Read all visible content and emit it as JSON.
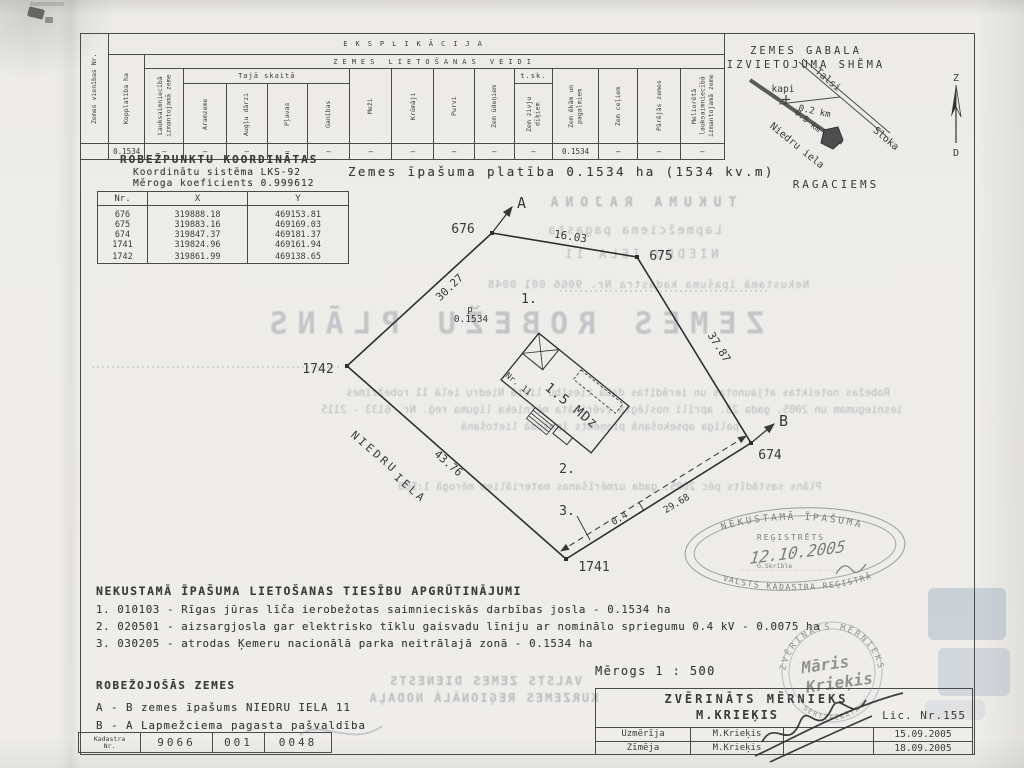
{
  "explication": {
    "title": "EKSPLIKĀCIJA",
    "land_use_title": "ZEMES LIETOŠANAS VEIDI",
    "including": "Tajā skaitā",
    "tsk": "t.sk.",
    "col_unit": "Zemes vienības Nr.",
    "col_total": "Kopplatība ha",
    "col_agri": "Lauksaimniecībā izmantojamā zeme",
    "col_arable": "Aramzeme",
    "col_orchards": "Augļu dārzi",
    "col_meadows": "Pļavas",
    "col_pastures": "Ganības",
    "col_forests": "Meži",
    "col_shrubs": "Krūmāji",
    "col_swamps": "Purvi",
    "col_water": "Zem ūdeņiem",
    "col_fishponds": "Zem zivju dīķiem",
    "col_buildings": "Zem ēkām un pagalmiem",
    "col_roads": "Zem ceļiem",
    "col_other": "Pārējās zemes",
    "col_ameliorated": "Meliorētā lauksaimniecībā izmantojamā zeme",
    "row": {
      "unit": "",
      "total": "0.1534",
      "agri": "—",
      "arable": "—",
      "orchards": "—",
      "meadows": "—",
      "pastures": "—",
      "forests": "—",
      "shrubs": "—",
      "swamps": "—",
      "water": "—",
      "fishponds": "—",
      "buildings": "0.1534",
      "roads": "—",
      "other": "—",
      "ameliorated": "—"
    }
  },
  "coords": {
    "title": "ROBEŽPUNKTU KOORDINĀTAS",
    "system": "Koordinātu sistēma LKS-92",
    "scale_coef": "Mēroga koeficients 0.999612",
    "headers": {
      "nr": "Nr.",
      "x": "X",
      "y": "Y"
    },
    "rows": [
      {
        "nr": "676",
        "x": "319888.18",
        "y": "469153.81"
      },
      {
        "nr": "675",
        "x": "319883.16",
        "y": "469169.03"
      },
      {
        "nr": "674",
        "x": "319847.37",
        "y": "469181.37"
      },
      {
        "nr": "1741",
        "x": "319824.96",
        "y": "469161.94"
      },
      {
        "nr": "1742",
        "x": "319861.99",
        "y": "469138.65"
      }
    ]
  },
  "area_statement": "Zemes īpašuma platība 0.1534 ha (1534 kv.m)",
  "scheme": {
    "title1": "ZEMES GABALA",
    "title2": "IZVIETOJUMA SHĒMA",
    "road_up": "Talsi",
    "road_down": "Sloka",
    "street": "Niedru iela",
    "cemetery": "kapi",
    "dist1": "0.2 km",
    "dist2": "0.5 km",
    "village": "RAGACIEMS",
    "north": "Z",
    "south": "D"
  },
  "plan": {
    "dirA": "A",
    "dirB": "B",
    "p676": "676",
    "p675": "675",
    "p674": "674",
    "p1741": "1741",
    "p1742": "1742",
    "len_676_675": "16.03",
    "len_675_674": "37.87",
    "len_1742_1741": "43.76",
    "len_676_1742": "30.27",
    "strip_width": "0.4",
    "strip_length": "29.68",
    "zone1": "1.",
    "zone2": "2.",
    "zone3": "3.",
    "area_p": "p",
    "area_val": "0.1534",
    "street_word1": "NIEDRU",
    "street_word2": "IELA",
    "building_label": "1.5 MDz",
    "building_nr": "Nr. 11"
  },
  "encumbrances": {
    "title": "NEKUSTAMĀ ĪPAŠUMA LIETOŠANAS TIESĪBU APGRŪTINĀJUMI",
    "item1": "1. 010103  -  Rīgas jūras līča ierobežotas saimnieciskās darbības josla - 0.1534 ha",
    "item2": "2. 020501 -  aizsargjosla gar elektrisko tīklu gaisvadu līniju ar nominālo spriegumu 0.4 kV  - 0.0075 ha",
    "item3": "3. 030205  -  atrodas Ķemeru nacionālā parka neitrālajā zonā - 0.1534 ha"
  },
  "bordering": {
    "title": "ROBEŽOJOŠĀS ZEMES",
    "item1": "A  -  B  zemes īpašums NIEDRU IELA 11",
    "item2": "B  -  A  Lapmežciema pagasta pašvaldība"
  },
  "cadastre": {
    "label1": "Kadastra",
    "label2": "Nr.",
    "n1": "9066",
    "n2": "001",
    "n3": "0048"
  },
  "surveyor": {
    "scale": "Mērogs 1 : 500",
    "title": "ZVĒRINĀTS MĒRNIEKS",
    "name": "M.KRIEĶIS",
    "lic": "Lic. Nr.155",
    "row1_label": "Uzmērīja",
    "row1_name": "M.Krieķis",
    "row1_date": "15.09.2005",
    "row2_label": "Zīmēja",
    "row2_name": "M.Krieķis",
    "row2_date": "18.09.2005"
  },
  "stamps": {
    "oval_top": "NEKUSTAMĀ ĪPAŠUMA",
    "oval_mid": "REĢISTRĒTS",
    "oval_date": "12.10.2005",
    "oval_clerk": "G.Skrīble",
    "oval_bottom": "VALSTS KADASTRA REĢISTRĀ",
    "round_top": "ZVĒRINĀTS MĒRNIEKS",
    "round_bottom": "SERTIFIKĀTA",
    "round_name1": "Māris",
    "round_name2": "Krieķis"
  },
  "ghost": {
    "line1": "TUKUMA RAJONA",
    "line2": "Lapmežciema pagasta",
    "line3": "NIEDRU IELA 11",
    "line4": "Nekustamā īpašuma kadastra Nr.  9066 001 0048",
    "title": "ZEMES ROBEŽU PLĀNS",
    "para1": "Robežas noteiktas atjaunotas un ierādītas dabā tiesību lietā Niedru ielā 11 robežzīmes",
    "para2": "iesniegumam un 2005. gada 23. aprīlī noslēgtā zvērināta mērnieka līguma reģ. Nr. 6133 - 2115",
    "para3": "palīga apsekošanā pieņemts īpašumā lietošanā",
    "para4": "Plāns sastādīts pēc 2005. gada uzmērīšanas materiāliem mērogā 1:500",
    "agency1": "VALSTS ZEMES DIENESTS",
    "agency2": "KURZEMES REĢIONĀLĀ NODAĻA"
  }
}
